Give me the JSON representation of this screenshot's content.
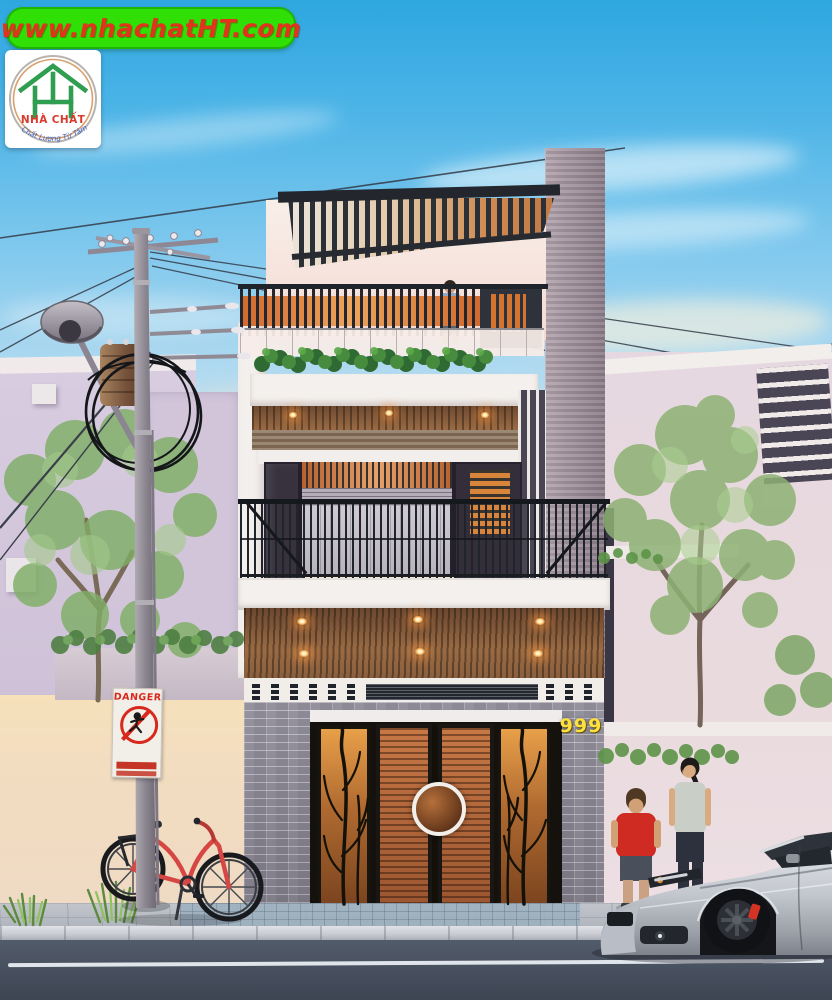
{
  "watermark": {
    "text": "www.nhachatHT.com"
  },
  "logo": {
    "brand": "NHÀ CHẤT",
    "slogan": "Chất Lượng Từ Tâm"
  },
  "house": {
    "number": "999"
  },
  "danger_sign": {
    "title": "DANGER"
  },
  "colors": {
    "banner_green": "#2fdf06",
    "banner_text_red": "#e2331c",
    "logo_brand_red": "#d93a2b",
    "logo_slogan_blue": "#3c63c2",
    "logo_house_green": "#2f9e50",
    "house_number_yellow": "#ffe13c",
    "sky_top_blue": "#2ea7e0",
    "sunset_cream": "#f7e3b8",
    "brick_gray": "#8f8c99",
    "wood_door_warm": "#b3663c",
    "downlight_orange": "#ff9e3e",
    "car_silver": "#c9cdd4",
    "bike_red": "#d64743",
    "road_slate": "#46505f"
  },
  "scene_objects": [
    "utility-pole",
    "street-lamp",
    "transformer",
    "wire-coil",
    "danger-sign",
    "red-bicycle",
    "left-tree",
    "right-tree",
    "terrace-man",
    "boy-red-shirt",
    "woman",
    "silver-suv",
    "terrace-planter",
    "wood-pergola",
    "balcony-railing",
    "wood-slat-doors",
    "brick-facade"
  ]
}
